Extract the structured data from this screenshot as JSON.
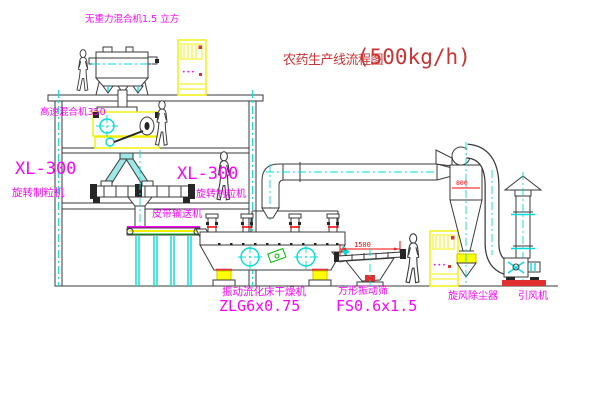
{
  "title": {
    "text": "农药生产线流程图",
    "capacity": "(500kg/h)"
  },
  "labels": {
    "gravity_mixer": "无重力混合机1.5 立方",
    "high_speed_mixer": "高速混合机350",
    "granulator_left_model": "XL-300",
    "granulator_left_name": "旋转制粒机",
    "granulator_mid_model": "XL-300",
    "granulator_mid_name": "旋转制粒机",
    "belt_conveyor": "皮带输送机",
    "dryer_name": "振动流化床干燥机",
    "dryer_model": "ZLG6x0.75",
    "screen_name": "方形振动筛",
    "screen_model": "FS0.6x1.5",
    "cyclone": "旋风除尘器",
    "fan": "引风机"
  },
  "dimensions": {
    "screen_length": "1500",
    "cyclone_body": "800"
  },
  "control_cabinet": {
    "buttons_glyph": "•••"
  },
  "colors": {
    "label_magenta": "#ff00ff",
    "title_red": "#cc3333",
    "dimension_red": "#ff0000",
    "equipment_yellow": "#ffff00",
    "centerline_cyan": "#00dcdc",
    "accent_green": "#00bb00",
    "line_gray": "#3a3a3a"
  }
}
